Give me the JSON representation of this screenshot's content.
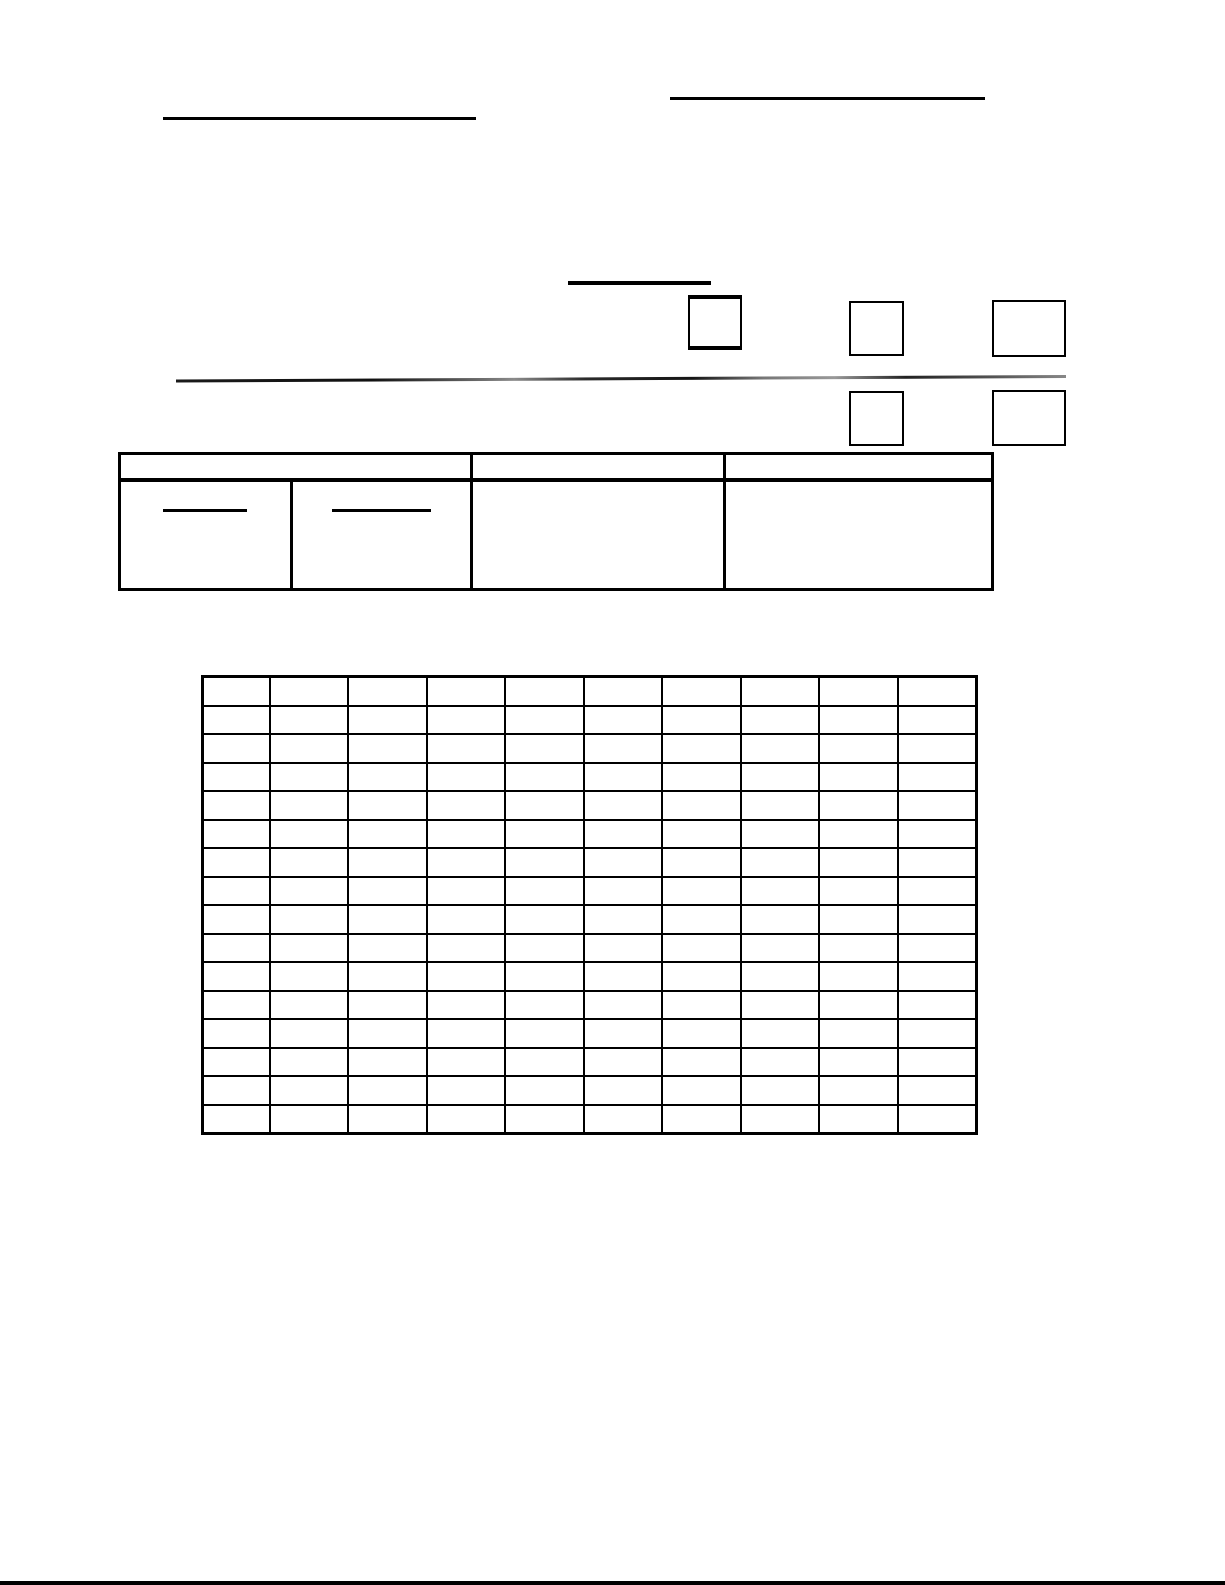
{
  "page": {
    "width": 1225,
    "height": 1585,
    "paper_color": "#ffffff",
    "ink_color": "#000000",
    "kind": "blank scanned form page",
    "visible_text": ""
  },
  "blanks": [
    {
      "name": "top-right-blank-line",
      "x": 670,
      "y": 97,
      "w": 315,
      "h": 3
    },
    {
      "name": "top-left-blank-line",
      "x": 163,
      "y": 117,
      "w": 313,
      "h": 3
    },
    {
      "name": "checkbox-section-title-blank-line",
      "x": 568,
      "y": 281,
      "w": 143,
      "h": 4
    }
  ],
  "checkboxes": [
    {
      "name": "checkbox-1",
      "x": 688,
      "y": 295,
      "w": 54,
      "h": 55,
      "bold": true
    },
    {
      "name": "checkbox-2",
      "x": 849,
      "y": 301,
      "w": 55,
      "h": 55,
      "bold": false
    },
    {
      "name": "checkbox-3",
      "x": 992,
      "y": 300,
      "w": 74,
      "h": 57,
      "bold": false
    },
    {
      "name": "checkbox-4",
      "x": 849,
      "y": 391,
      "w": 55,
      "h": 55,
      "bold": false
    },
    {
      "name": "checkbox-5",
      "x": 992,
      "y": 390,
      "w": 74,
      "h": 56,
      "bold": false
    }
  ],
  "section_rule": {
    "x": 176,
    "y": 375,
    "w": 890,
    "h": 3,
    "tilt_deg": -0.29
  },
  "info_table": {
    "x": 118,
    "y": 452,
    "w": 876,
    "h": 139,
    "outer_border": 3,
    "header_height": 23,
    "header_rule_weight": 4,
    "divider_weight": 3,
    "full_height_dividers_x": [
      349,
      602
    ],
    "body_only_divider_x": 169,
    "header_cell_count": 3,
    "body_cell_count": 4,
    "cell_blank_lines": [
      {
        "name": "info-cell-1-blank-line",
        "x": 42,
        "y": 54,
        "w": 84,
        "h": 3
      },
      {
        "name": "info-cell-2-blank-line",
        "x": 211,
        "y": 54,
        "w": 99,
        "h": 3
      }
    ]
  },
  "grid_table": {
    "x": 201,
    "y": 675,
    "w": 777,
    "h": 460,
    "rows": 16,
    "columns": 10,
    "first_column_width_px": 65,
    "outer_border": 3,
    "line_weight": 2,
    "cells_empty": true
  },
  "page_edge_bar": {
    "y": 1581,
    "h": 4
  }
}
